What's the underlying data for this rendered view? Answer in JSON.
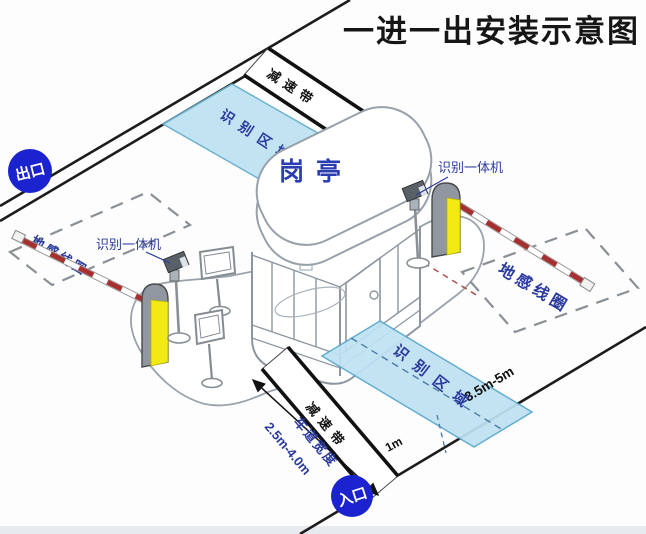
{
  "title": "一进一出安装示意图",
  "badges": {
    "exit": "出口",
    "entrance": "入口"
  },
  "booth": {
    "label": "岗亭"
  },
  "exit_lane": {
    "camera_label": "识别一体机",
    "loop_label": "地感线圈",
    "zone_label": "识别区域",
    "bump_label": "减速带"
  },
  "entry_lane": {
    "camera_label": "识别一体机",
    "loop_label": "地感线圈",
    "zone_label": "识别区域",
    "bump_label": "减速带",
    "loop_length": "3.5m-5m",
    "zone_gap": "1m",
    "lane_width_label": "车道宽度",
    "lane_width_value": "2.5m-4.0m"
  },
  "colors": {
    "badge_blue": "#1b23cf",
    "label_blue": "#2b3a9e",
    "zone_fill": "#bfe2f2",
    "machine_yellow": "#f2ea12",
    "arm_red": "#a63030"
  }
}
